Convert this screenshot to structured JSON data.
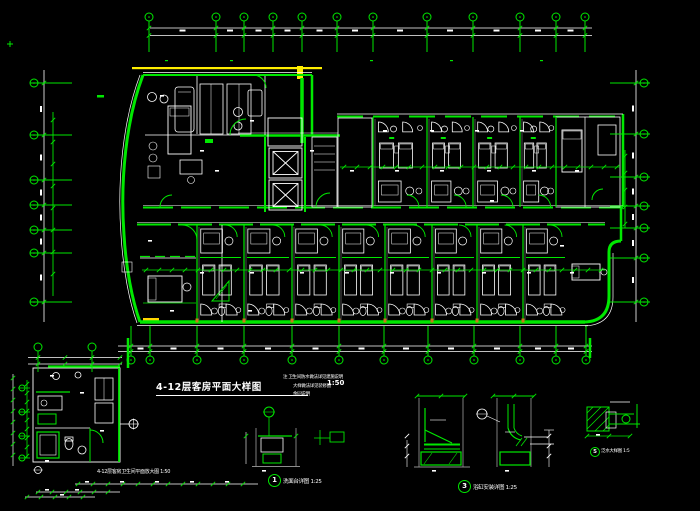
{
  "drawing": {
    "title": {
      "text": "4-12层客房平面大样图",
      "scale": "1:50"
    },
    "notes": {
      "lines": [
        "注 卫生间防水做法详见建施说明",
        "大样做法详见装修图",
        "余同说明"
      ]
    },
    "captions": {
      "bathroom_plan": "4-12层客房卫生间平面放大图 1:50",
      "detail_1": {
        "num": "1",
        "label": "洗面台详图",
        "scale": "1:25"
      },
      "detail_3": {
        "num": "3",
        "label": "浴缸安装详图",
        "scale": "1:25"
      },
      "detail_5": {
        "num": "5",
        "label": "泛水大样图",
        "scale": "1:5"
      }
    },
    "colors": {
      "line_green": "#00e800",
      "line_white": "#ffffff",
      "highlight_yellow": "#ffee00",
      "accent_orange": "#c87818",
      "detail_gray": "#8c8c8c",
      "background": "#000000"
    },
    "grid": {
      "top_x": [
        149,
        216,
        244,
        273,
        302,
        337,
        373,
        427,
        473,
        520,
        556,
        585
      ],
      "left_y": [
        83,
        135,
        180,
        205,
        230,
        253,
        302
      ],
      "right_y": [
        83,
        134,
        177,
        206,
        228,
        258,
        302
      ],
      "bottom_x": [
        131,
        150,
        197,
        244,
        292,
        339,
        384,
        428,
        474,
        520,
        556,
        586
      ],
      "detail_top_x": [
        38,
        92
      ],
      "detail_left_y": [
        388,
        412,
        436,
        458
      ]
    },
    "rooms": {
      "top_bays": [
        337,
        373,
        427,
        473,
        520,
        556
      ],
      "bottom_bays": [
        197,
        244,
        292,
        339,
        385,
        432,
        477,
        523,
        568
      ]
    }
  }
}
